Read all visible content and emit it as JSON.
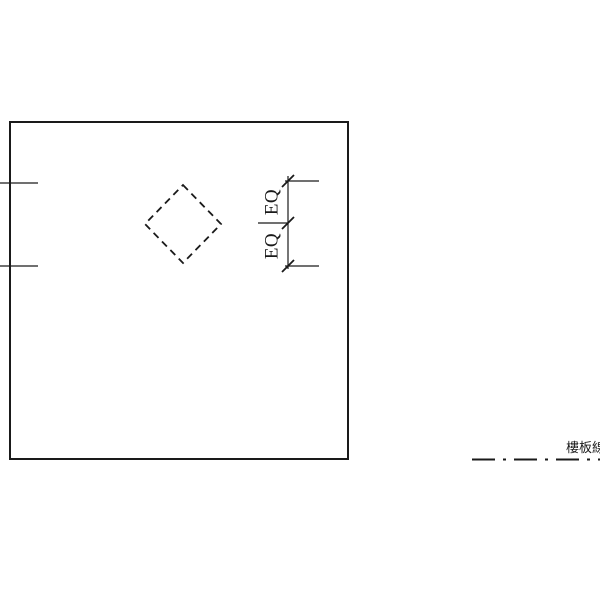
{
  "drawing": {
    "labels": {
      "eq_top": "EQ",
      "eq_bottom": "EQ",
      "slab_line_label": "樓板線"
    },
    "colors": {
      "line": "#1a1a1a",
      "background": "#ffffff"
    }
  }
}
